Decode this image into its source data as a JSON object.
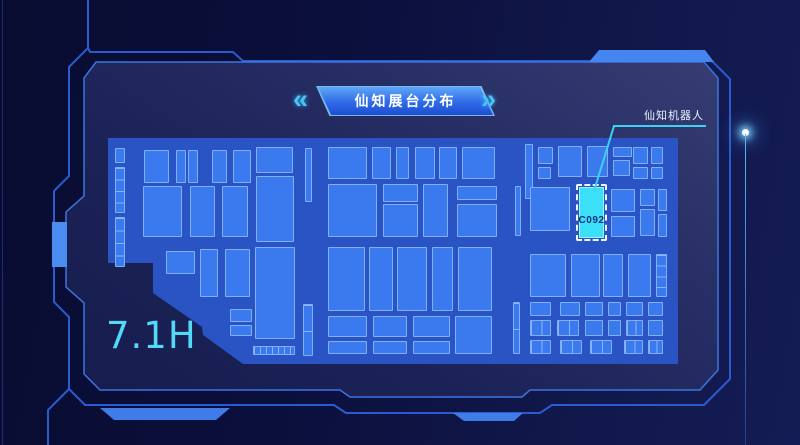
{
  "banner": {
    "title": "仙知展台分布",
    "left_chevron": "«",
    "right_chevron": "»"
  },
  "hall_label": "7.1H",
  "callout": {
    "label": "仙知机器人"
  },
  "highlight_booth": {
    "id": "C092"
  },
  "colors": {
    "background": "#0b0f3c",
    "panel": "#1b2257",
    "frame_line": "#2a5cd0",
    "floor": "#2a53c4",
    "booth_fill": "#3b79ee",
    "booth_border": "#7fb1fa",
    "highlight_fill": "#3be0f8",
    "accent_cyan": "#54d8f8",
    "pointer_line": "#3cd2f4",
    "banner_top": "#5fa6f8",
    "banner_bottom": "#1c4ed2",
    "title_text": "#ffffff"
  },
  "map": {
    "origin": [
      100,
      134
    ],
    "size": [
      580,
      232
    ],
    "floor_polygon": [
      [
        8,
        4
      ],
      [
        578,
        4
      ],
      [
        578,
        230
      ],
      [
        143,
        230
      ],
      [
        103,
        201
      ],
      [
        102,
        193
      ],
      [
        53,
        159
      ],
      [
        53,
        129
      ],
      [
        8,
        129
      ]
    ],
    "highlight": {
      "x": 476,
      "y": 50,
      "w": 31,
      "h": 57,
      "inner": {
        "x": 479,
        "y": 53,
        "w": 25,
        "h": 51
      }
    },
    "pointer": [
      [
        706,
        126
      ],
      [
        614,
        126
      ],
      [
        594,
        191
      ]
    ],
    "booths": [
      [
        15,
        14,
        10,
        15
      ],
      [
        15,
        33,
        10,
        46,
        "v4"
      ],
      [
        15,
        83,
        10,
        50,
        "v4"
      ],
      [
        44,
        16,
        25,
        33
      ],
      [
        76,
        16,
        10,
        33
      ],
      [
        88,
        16,
        10,
        33
      ],
      [
        112,
        16,
        15,
        33
      ],
      [
        133,
        16,
        18,
        33
      ],
      [
        156,
        13,
        37,
        26
      ],
      [
        156,
        42,
        38,
        66
      ],
      [
        43,
        52,
        39,
        51
      ],
      [
        90,
        52,
        25,
        51
      ],
      [
        122,
        52,
        26,
        51
      ],
      [
        205,
        14,
        7,
        54
      ],
      [
        66,
        117,
        29,
        23
      ],
      [
        100,
        115,
        18,
        48
      ],
      [
        125,
        115,
        25,
        48
      ],
      [
        155,
        113,
        40,
        92
      ],
      [
        130,
        175,
        22,
        13
      ],
      [
        130,
        191,
        22,
        11
      ],
      [
        153,
        212,
        42,
        9,
        "h7"
      ],
      [
        228,
        13,
        39,
        32
      ],
      [
        272,
        13,
        19,
        32
      ],
      [
        296,
        13,
        13,
        32
      ],
      [
        315,
        13,
        20,
        32
      ],
      [
        339,
        13,
        18,
        32
      ],
      [
        362,
        13,
        33,
        32
      ],
      [
        228,
        50,
        49,
        53
      ],
      [
        283,
        50,
        35,
        18
      ],
      [
        283,
        70,
        35,
        33
      ],
      [
        323,
        50,
        25,
        53
      ],
      [
        357,
        52,
        40,
        14
      ],
      [
        357,
        70,
        40,
        33
      ],
      [
        415,
        52,
        6,
        50
      ],
      [
        228,
        113,
        37,
        64
      ],
      [
        269,
        113,
        24,
        64
      ],
      [
        297,
        113,
        30,
        64
      ],
      [
        332,
        113,
        21,
        64
      ],
      [
        358,
        113,
        34,
        64
      ],
      [
        228,
        182,
        39,
        21
      ],
      [
        273,
        182,
        34,
        21
      ],
      [
        313,
        182,
        37,
        21
      ],
      [
        355,
        182,
        37,
        38
      ],
      [
        228,
        207,
        39,
        13
      ],
      [
        273,
        207,
        34,
        13
      ],
      [
        313,
        207,
        37,
        13
      ],
      [
        203,
        170,
        10,
        52,
        "v2"
      ],
      [
        413,
        168,
        7,
        52,
        "v2"
      ],
      [
        425,
        10,
        8,
        55
      ],
      [
        438,
        13,
        15,
        17
      ],
      [
        438,
        33,
        13,
        12
      ],
      [
        458,
        12,
        24,
        31
      ],
      [
        487,
        12,
        21,
        31
      ],
      [
        513,
        13,
        19,
        10
      ],
      [
        513,
        26,
        17,
        16
      ],
      [
        533,
        13,
        15,
        17
      ],
      [
        551,
        13,
        12,
        17
      ],
      [
        533,
        33,
        15,
        12
      ],
      [
        551,
        33,
        12,
        12
      ],
      [
        430,
        53,
        40,
        44
      ],
      [
        511,
        55,
        24,
        23
      ],
      [
        511,
        82,
        24,
        21
      ],
      [
        540,
        55,
        15,
        17
      ],
      [
        540,
        75,
        15,
        27
      ],
      [
        558,
        55,
        9,
        22
      ],
      [
        558,
        80,
        9,
        23
      ],
      [
        430,
        120,
        36,
        43
      ],
      [
        471,
        120,
        29,
        43
      ],
      [
        503,
        120,
        20,
        43
      ],
      [
        528,
        120,
        23,
        43
      ],
      [
        556,
        120,
        11,
        43,
        "v4"
      ],
      [
        430,
        168,
        21,
        14
      ],
      [
        460,
        168,
        20,
        14
      ],
      [
        485,
        168,
        18,
        14
      ],
      [
        508,
        168,
        13,
        14
      ],
      [
        526,
        168,
        17,
        14
      ],
      [
        548,
        168,
        15,
        14
      ],
      [
        430,
        186,
        21,
        16,
        "h2"
      ],
      [
        457,
        186,
        22,
        16,
        "h2"
      ],
      [
        485,
        186,
        18,
        16
      ],
      [
        508,
        186,
        13,
        16
      ],
      [
        526,
        186,
        17,
        16,
        "h2"
      ],
      [
        548,
        186,
        15,
        16
      ],
      [
        430,
        206,
        21,
        14,
        "h2"
      ],
      [
        460,
        206,
        22,
        14,
        "h2"
      ],
      [
        490,
        206,
        22,
        14,
        "h2"
      ],
      [
        524,
        206,
        19,
        14,
        "h2"
      ],
      [
        548,
        206,
        15,
        14,
        "h2"
      ]
    ]
  }
}
